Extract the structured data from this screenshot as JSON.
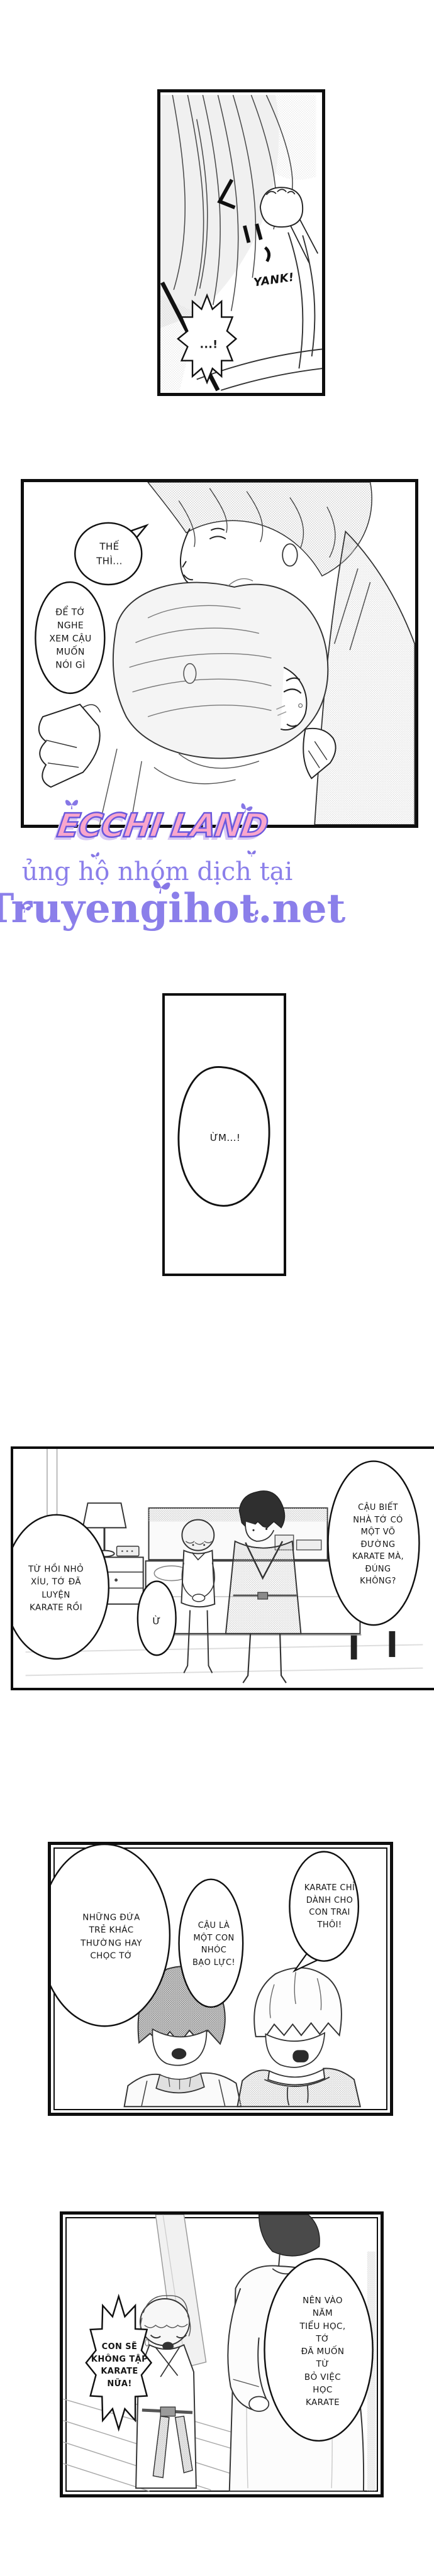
{
  "page": {
    "type": "manga-page",
    "language": "Vietnamese"
  },
  "panels": {
    "p1": {
      "sfx": "YANK!",
      "bubble_exclaim": "...!"
    },
    "p2": {
      "bubble_small": "THẾ\nTHÌ...",
      "bubble_big": "ĐỂ TỚ\nNGHE\nXEM CẬU\nMUỐN\nNÓI GÌ"
    },
    "p3": {
      "bubble": "ỪM...!"
    },
    "p4": {
      "bubble_right": "CẬU BIẾT\nNHÀ TỚ CÓ\nMỘT VÕ\nĐƯỜNG\nKARATE MÀ,\nĐÚNG\nKHÔNG?",
      "bubble_yes": "Ừ",
      "bubble_left": "TỪ HỒI NHỎ\nXÍU, TỚ ĐÃ\nLUYỆN\nKARATE RỒI"
    },
    "p5": {
      "bubble_left": "NHỮNG ĐỨA\nTRẺ KHÁC\nTHƯỜNG HAY\nCHỌC TỚ",
      "bubble_mid": "CẬU LÀ\nMỘT CON\nNHÓC\nBẠO LỰC!",
      "bubble_right": "KARATE CHỈ\nDÀNH CHO\nCON TRAI\nTHÔI!"
    },
    "p6": {
      "bubble_spiky": "CON SẼ\nKHÔNG TẬP\nKARATE\nNỮA!",
      "bubble_big": "NÊN VÀO NĂM\nTIỂU HỌC, TỚ\nĐÃ MUỐN TỪ\nBỎ VIỆC HỌC\nKARATE"
    }
  },
  "watermark": {
    "title": "ECCHI LAND",
    "subtitle": "ủng hộ nhóm dịch tại",
    "site": "Truyengihot.net",
    "title_fill": "#f9a6cc",
    "title_outline": "#6a58dd",
    "accent": "#8b7fea",
    "butterfly_color": "#8677e6"
  }
}
